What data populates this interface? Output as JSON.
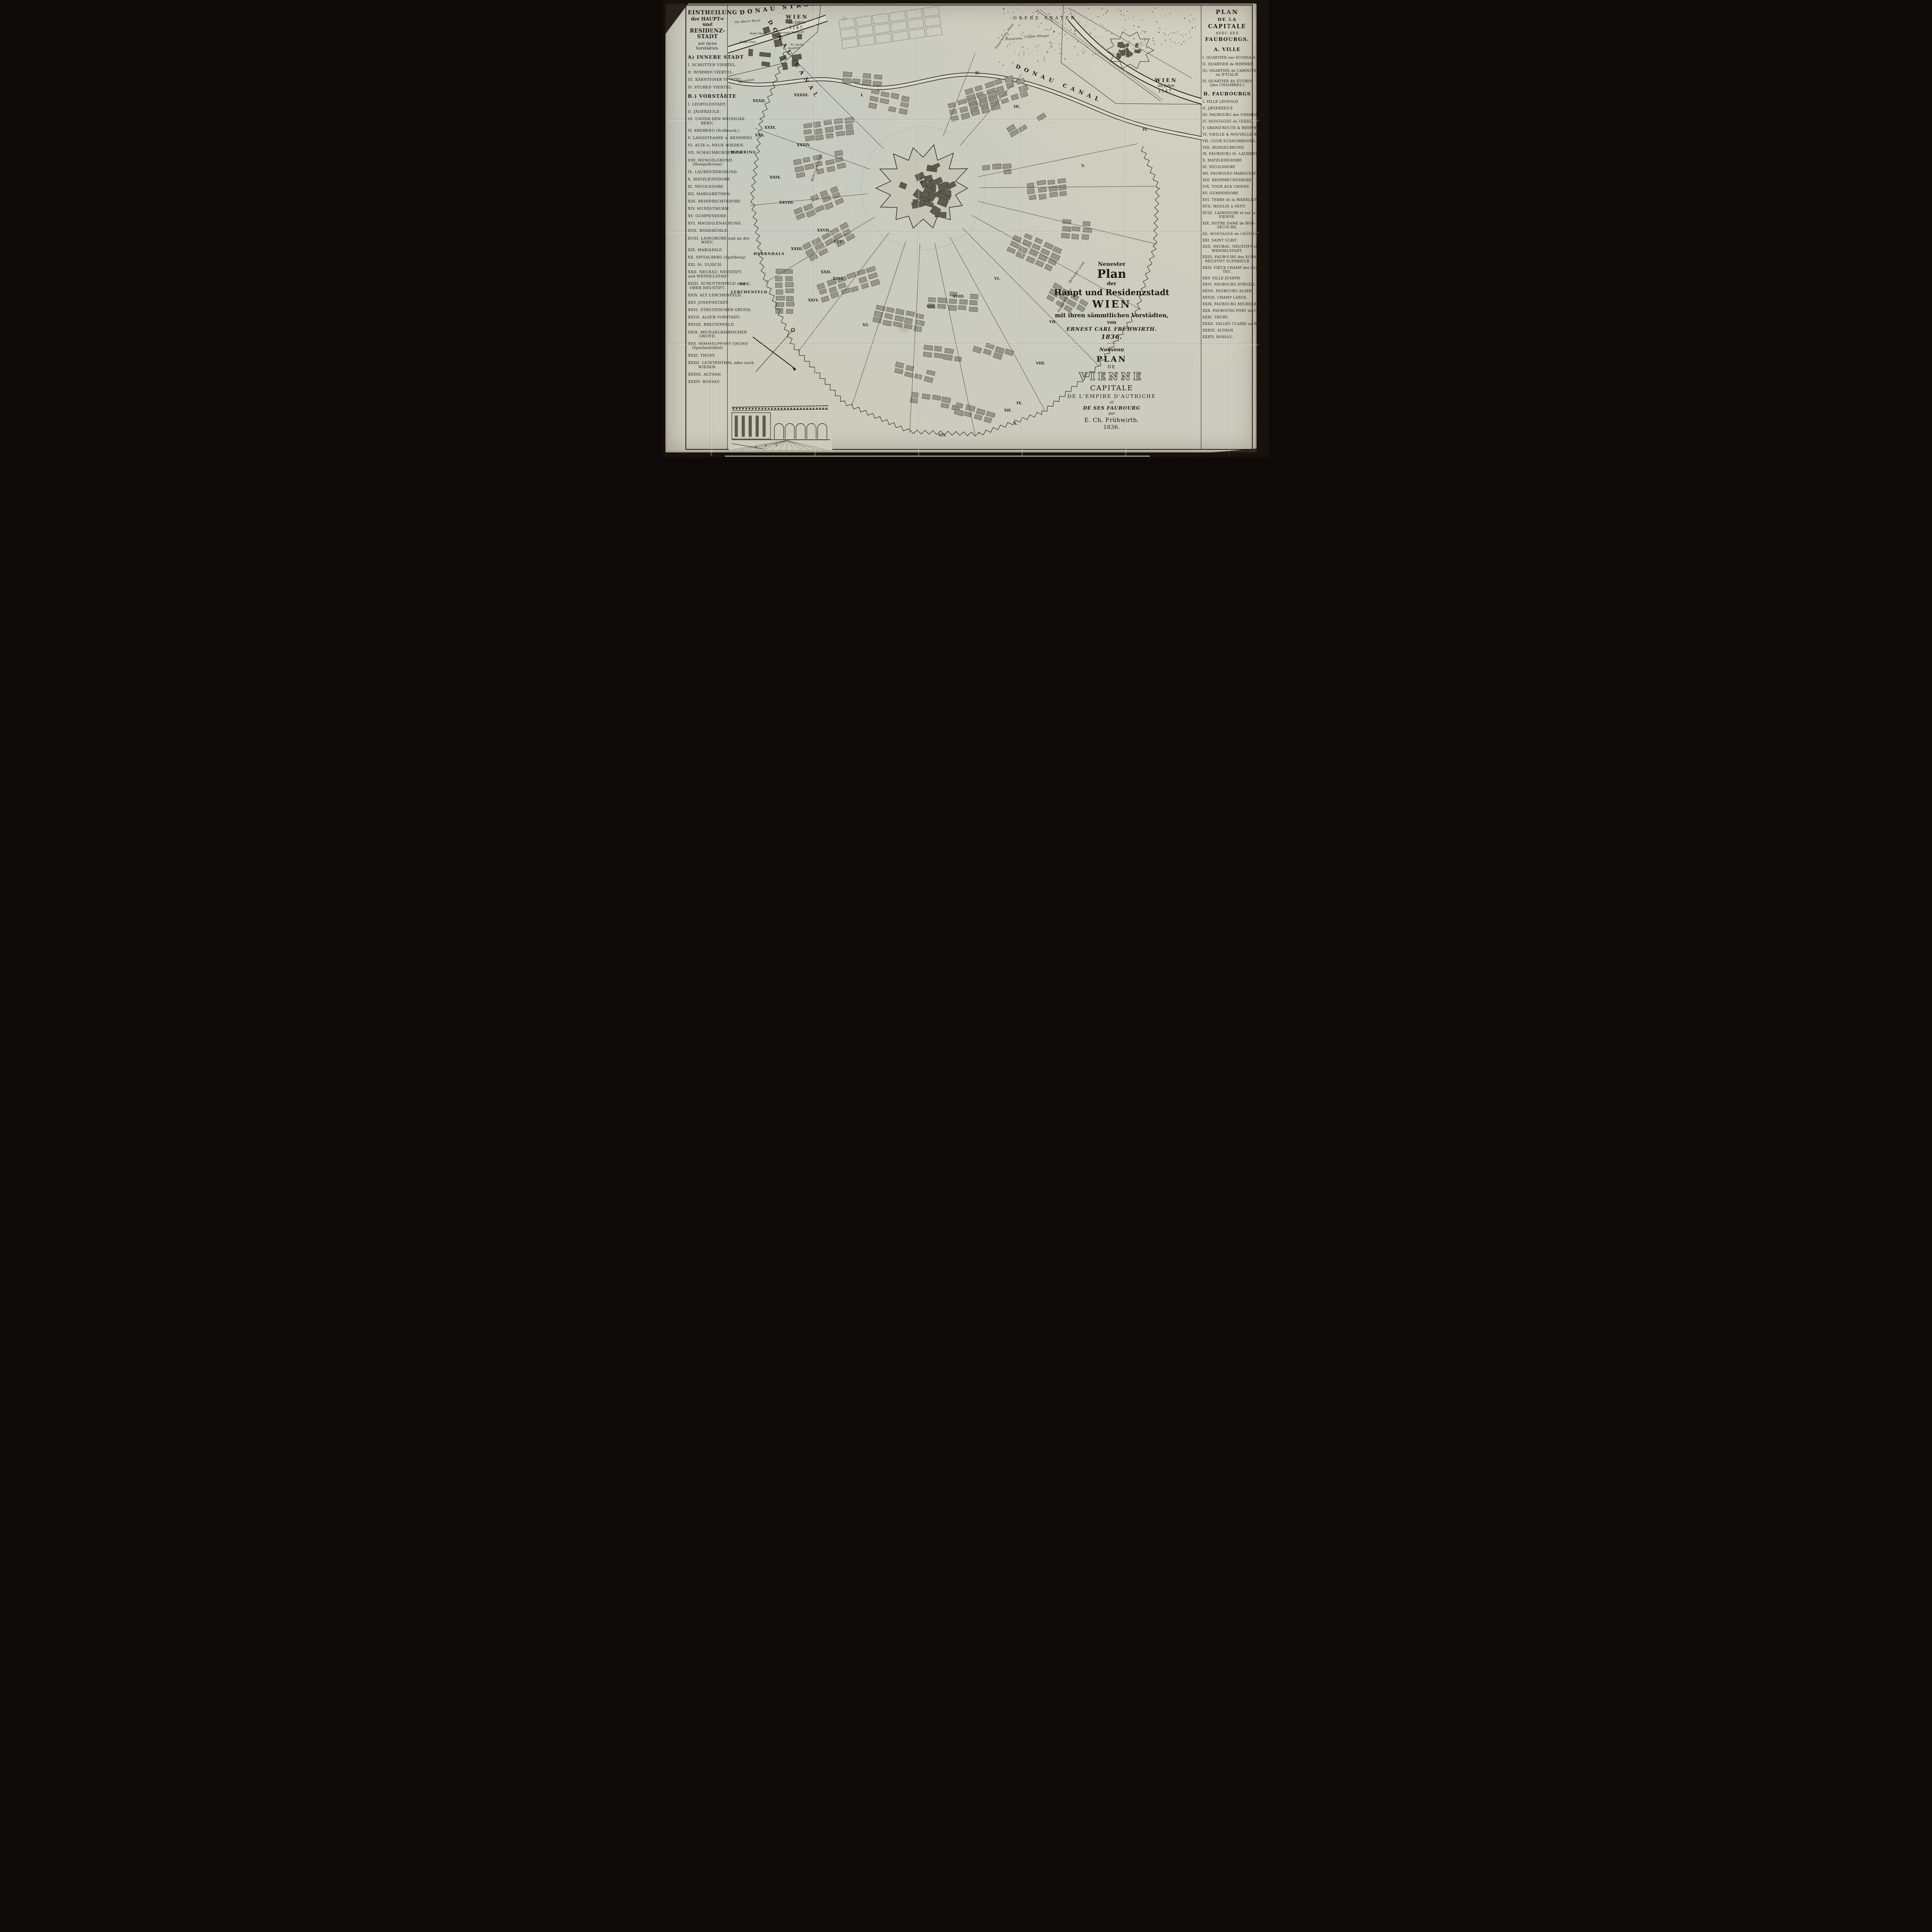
{
  "colors": {
    "paper": "#ccccbe",
    "ink": "#1c1912",
    "block_gray": "#a09e90",
    "block_dark": "#5d5b50",
    "photo_border": "#17110c",
    "bottom_sliver": "#b9c4a4"
  },
  "left_panel": {
    "title_lines": [
      "EINTHEILUNG",
      "der HAUPT= und",
      "RESIDENZ-STADT",
      "mit ihren Vorstädten."
    ],
    "section_a_heading": "A) INNERE STADT",
    "section_a_items": [
      {
        "t": "I. SCHOTTEN VIERTEL."
      },
      {
        "t": "II. WIMMER VIERTEL."
      },
      {
        "t": "III. KÄRNTHNER VIERTEL."
      },
      {
        "t": "IV. STUBEN VIERTEL."
      }
    ],
    "section_b_heading": "B.) VORSTÄDTE",
    "section_b_items": [
      {
        "t": "I. LEOPOLDSTADT."
      },
      {
        "t": "II. JÄGERZEILE."
      },
      {
        "t": "III. UNTER DEN WEISSGÄR",
        "t2": "BERN."
      },
      {
        "t": "IV. ERDBERG (Erdbruch.)"
      },
      {
        "t": "V. LANDSTRASSE u. RENNWEG"
      },
      {
        "t": "VI. ALTE u. NEUE WIEDEN."
      },
      {
        "t": "VII. SCHAUMBURGERHOF."
      },
      {
        "t": "VIII. HUNGELGRUND.",
        "t2": "(Hungelbrunn)"
      },
      {
        "t": "IX. LAURENZERGRUND."
      },
      {
        "t": "X. MATZLEINSDORF."
      },
      {
        "t": "XI. NICOLSDORF."
      },
      {
        "t": "XII. MARGARETHEN."
      },
      {
        "t": "XIII. REINPRECHTSDORF."
      },
      {
        "t": "XIV. HUNDSTHURM."
      },
      {
        "t": "XV. GUMPENDORF."
      },
      {
        "t": "XVI. MAGDALENAGRUND."
      },
      {
        "t": "XVII. WINDMÜHLE."
      },
      {
        "t": "XVIII. LAIMGRUBE und an der",
        "t2": "WIEN."
      },
      {
        "t": "XIX. MARIAHILF."
      },
      {
        "t": "XX. SPITALBERG (Spitlberg)"
      },
      {
        "t": "XXI. St. ULRICH."
      },
      {
        "t": "XXII. NEUBAU, NEUSTIFT.",
        "t2": "und WENDELSTADT"
      },
      {
        "t": "XXIII. SCHOTTENFELD oder",
        "t2": "OBER NEUSTIFT."
      },
      {
        "t": "XXIV. ALT LERCHENFELD."
      },
      {
        "t": "XXV. JOSEPHSTADT."
      },
      {
        "t": "XXVI. STROTZISCHER GRUND."
      },
      {
        "t": "XXVII. ALSER VORSTADT."
      },
      {
        "t": "XXVIII. BREITENFELD."
      },
      {
        "t": "XXIX. MICHAELBAIRISCHER",
        "t2": "GRUND."
      },
      {
        "t": "XXX. HIMMELPFORT GRUND",
        "t2": "(Sporkenbühel)"
      },
      {
        "t": "XXXI. THURY."
      },
      {
        "t": "XXXII. LICHTENTHAL oder auch",
        "t2": "WIESEN."
      },
      {
        "t": "XXXIII. ALTHAN."
      },
      {
        "t": "XXXIV. ROSSAU."
      }
    ]
  },
  "right_panel": {
    "title_lines": [
      "PLAN",
      "DE LA",
      "CAPITALE",
      "AVEC SES",
      "FAUBOURGS."
    ],
    "section_a_heading": "A. VILLE",
    "section_a_items": [
      {
        "t": "I. QUARTIER des ECOSSAIS."
      },
      {
        "t": "II. QUARTIER de WIMMER."
      },
      {
        "t": "III. QUARTIER de CARINTHIE",
        "t2": "ou D'ITALIE"
      },
      {
        "t": "IV. QUARTIER dit STUBEN",
        "t2": "(des CHAMBRES.)"
      }
    ],
    "section_b_heading": "B. FAUBOURGS",
    "section_b_items": [
      {
        "t": "I. VILLE LEOPOLD"
      },
      {
        "t": "II. JÆGERZEILE"
      },
      {
        "t": "III. FAUBOURG des CHAMOISSEURS"
      },
      {
        "t": "IV. MONTAGNE de TERRE."
      },
      {
        "t": "V. GRAND'ROUTE & RENNWEG."
      },
      {
        "t": "VI. VIEILLE & NOUVELLE WIEDEN."
      },
      {
        "t": "VII. COUR SCHAUMBOURG."
      },
      {
        "t": "VIII. HUNGELBRUNN."
      },
      {
        "t": "IX. FAUBOURG St. LAURENT."
      },
      {
        "t": "X. MATZLEINSDORF."
      },
      {
        "t": "XI. NICOLSDORF."
      },
      {
        "t": "XII. FAUBOURG MARGUERITE."
      },
      {
        "t": "XIII. REINPRECHTSDORF."
      },
      {
        "t": "IVX. TOUR AUX CHIENS"
      },
      {
        "t": "XV. GUMPENDORF."
      },
      {
        "t": "XVI. TERRE de la MADELEINE"
      },
      {
        "t": "XVII. MOULIN à VENT."
      },
      {
        "t": "XVIII. LAIMGRUBE et sur la",
        "t2": "VIENNE."
      },
      {
        "t": "XIX. NOTRE DAME de BON-",
        "t2": "SECOURS."
      },
      {
        "t": "XX. MONTAGNE de l'HÔPITAL."
      },
      {
        "t": "XXI. SAINT ULRIC"
      },
      {
        "t": "XXII. NEUBAU, NEUSTIFT et",
        "t2": "WENDELSTADT."
      },
      {
        "t": "XXIII. FAUBOURG des ECOSSAIS et",
        "t2": "NEUSTIFT SUPERIEUR"
      },
      {
        "t": "XXIV. VIEUX CHAMP des ALOUET-",
        "t2": "TES."
      },
      {
        "t": "XXV. VILLE JOSEPH."
      },
      {
        "t": "XXVI. FAUBOURG STROZZI."
      },
      {
        "t": "XXVII. FAUBOURG ALSER."
      },
      {
        "t": "XXVIII. CHAMP LARGE."
      },
      {
        "t": "XXIX. FAUBOURG MICHELBAIER."
      },
      {
        "t": "XXX. FAUBOURG PORT du CIEL."
      },
      {
        "t": "XXXI. THURY."
      },
      {
        "t": "XXXII. VALLÉE CLAIRE ou WIESEN."
      },
      {
        "t": "XXXIII. ALTHAN."
      },
      {
        "t": "XXXIV. ROSSAU."
      }
    ]
  },
  "insets": {
    "left": {
      "l1": "WIEN",
      "l2": "im Jahre",
      "l3": "1147."
    },
    "right": {
      "l1": "WIEN",
      "l2": "im Jahre",
      "l3": "1547."
    }
  },
  "cartouche": {
    "german": [
      {
        "t": "Neuester",
        "c": "frk f14"
      },
      {
        "t": "Plan",
        "c": "frk f30"
      },
      {
        "t": "der",
        "c": "frk f13"
      },
      {
        "t": "Haupt und Residenzstadt",
        "c": "frk f21 mt2"
      },
      {
        "t": "WIEN",
        "c": "capb f26 mt4"
      },
      {
        "t": "mit ihren sämmtlichen Vorstädten,",
        "c": "frk f15 mt4"
      },
      {
        "t": "von",
        "c": "frk f12 mt2"
      },
      {
        "t": "ERNEST CARL FRÜHWIRTH.",
        "c": "itc f13 mt4"
      },
      {
        "t": "1836.",
        "c": "itc f16 mt2"
      },
      {
        "t": "—·—",
        "c": "f10 mt2"
      }
    ],
    "french": [
      {
        "t": "Nouveau",
        "c": "scr f13 mt4"
      },
      {
        "t": "PLAN",
        "c": "capb f20 mt4"
      },
      {
        "t": "DE",
        "c": "cap f11 mt2"
      },
      {
        "t": "VIENNE",
        "c": "out f26 mt4"
      },
      {
        "t": "CAPITALE",
        "c": "cap f18 mt4"
      },
      {
        "t": "DE L'EMPIRE D'AUTRICHE",
        "c": "cap f13 mt4"
      },
      {
        "t": "et",
        "c": "itl f10 mt2"
      },
      {
        "t": "DE SES FAUBOURG",
        "c": "itc f12 mt2"
      },
      {
        "t": "par",
        "c": "itl f10 mt2"
      },
      {
        "t": "E. Ch. Frühwirth.",
        "c": "ser f15 mt2"
      },
      {
        "t": "1836.",
        "c": "ser f14 mt2"
      }
    ]
  },
  "map_labels": [
    {
      "text": "DONAU STROM",
      "x": 2.4,
      "y": 1.0,
      "rot": -7,
      "cls": "river-lg"
    },
    {
      "text": "Im obern Werd",
      "x": 1.4,
      "y": 3.6,
      "rot": -4,
      "cls": "script-sm"
    },
    {
      "text": "DONAU CANAL",
      "x": 9.2,
      "y": 3.2,
      "rot": 58,
      "cls": "canal-lg"
    },
    {
      "text": "DONAU CANAL",
      "x": 61.0,
      "y": 13.2,
      "rot": 22,
      "cls": "canal-lg"
    },
    {
      "text": "OBERE PRATER",
      "x": 60.2,
      "y": 2.4,
      "rot": 0,
      "cls": "area-lg"
    },
    {
      "text": "Feuerwerks Platz",
      "x": 56.2,
      "y": 9.6,
      "rot": -55,
      "cls": "script-sm"
    },
    {
      "text": "Panorama",
      "x": 58.6,
      "y": 7.4,
      "rot": -3,
      "cls": "script-sm"
    },
    {
      "text": "Caffee Häuser",
      "x": 62.6,
      "y": 6.9,
      "rot": -3,
      "cls": "script-sm"
    },
    {
      "text": "Spittelau",
      "x": 2.1,
      "y": 17.0,
      "rot": -10,
      "cls": "script-sm"
    },
    {
      "text": "WÆHRING",
      "x": 0.6,
      "y": 32.8,
      "rot": 0,
      "cls": "area-md"
    },
    {
      "text": "Währinger Linie",
      "x": 17.4,
      "y": 39.6,
      "rot": -72,
      "cls": "script-sm"
    },
    {
      "text": "HERRNHALS",
      "x": 5.4,
      "y": 55.6,
      "rot": 0,
      "cls": "area-md"
    },
    {
      "text": "NEU.",
      "x": 2.4,
      "y": 62.4,
      "rot": 0,
      "cls": "area-md"
    },
    {
      "text": "LERCHENFELD",
      "x": 0.6,
      "y": 64.2,
      "rot": 0,
      "cls": "area-md"
    },
    {
      "text": "Hohe Markt",
      "x": 4.6,
      "y": 6.2,
      "rot": 0,
      "cls": "tiny"
    },
    {
      "text": "Juden Platz",
      "x": 2.5,
      "y": 8.1,
      "rot": 0,
      "cls": "tiny"
    },
    {
      "text": "Vorstadt Wollzeile",
      "x": 10.6,
      "y": 6.1,
      "rot": -3,
      "cls": "tiny"
    },
    {
      "text": "St. Jacob",
      "x": 13.2,
      "y": 8.7,
      "rot": 0,
      "cls": "tiny"
    },
    {
      "text": "St. Stephan",
      "x": 11.6,
      "y": 9.6,
      "rot": -5,
      "cls": "tiny"
    },
    {
      "text": "Belveder Linie",
      "x": 71.8,
      "y": 62.2,
      "rot": -55,
      "cls": "script-sm"
    },
    {
      "text": "Favoriten Linie",
      "x": 69.4,
      "y": 68.8,
      "rot": -62,
      "cls": "script-sm"
    }
  ],
  "map_numerals": [
    {
      "n": "I.",
      "x": 28.0,
      "y": 19.9
    },
    {
      "n": "II.",
      "x": 52.2,
      "y": 14.9
    },
    {
      "n": "III.",
      "x": 60.3,
      "y": 22.5
    },
    {
      "n": "IV.",
      "x": 87.5,
      "y": 27.6
    },
    {
      "n": "V.",
      "x": 74.6,
      "y": 35.8
    },
    {
      "n": "VI.",
      "x": 56.2,
      "y": 61.1
    },
    {
      "n": "VII.",
      "x": 67.8,
      "y": 70.8
    },
    {
      "n": "VIII.",
      "x": 65.0,
      "y": 80.1
    },
    {
      "n": "IX.",
      "x": 60.9,
      "y": 89.1
    },
    {
      "n": "X.",
      "x": 60.3,
      "y": 93.7
    },
    {
      "n": "XII.",
      "x": 58.3,
      "y": 90.7
    },
    {
      "n": "XIII.",
      "x": 41.9,
      "y": 67.4
    },
    {
      "n": "XIV.",
      "x": 44.4,
      "y": 96.3
    },
    {
      "n": "XV.",
      "x": 28.4,
      "y": 71.5
    },
    {
      "n": "XVIII.",
      "x": 47.4,
      "y": 65.1
    },
    {
      "n": "XXII.",
      "x": 19.6,
      "y": 59.6
    },
    {
      "n": "XXIII.",
      "x": 13.3,
      "y": 54.4
    },
    {
      "n": "XXIV.",
      "x": 16.9,
      "y": 66.0
    },
    {
      "n": "XXV.",
      "x": 22.3,
      "y": 52.8
    },
    {
      "n": "XXVI.",
      "x": 22.1,
      "y": 61.1
    },
    {
      "n": "XXVII.",
      "x": 18.8,
      "y": 50.3
    },
    {
      "n": "XXVIII.",
      "x": 10.8,
      "y": 44.0
    },
    {
      "n": "XXIX.",
      "x": 8.8,
      "y": 38.4
    },
    {
      "n": "XXX.",
      "x": 5.7,
      "y": 28.9
    },
    {
      "n": "XXXI.",
      "x": 7.7,
      "y": 27.2
    },
    {
      "n": "XXXII.",
      "x": 5.2,
      "y": 21.2
    },
    {
      "n": "XXXIII.",
      "x": 13.9,
      "y": 19.9
    },
    {
      "n": "XXXIV.",
      "x": 14.5,
      "y": 31.1
    }
  ]
}
